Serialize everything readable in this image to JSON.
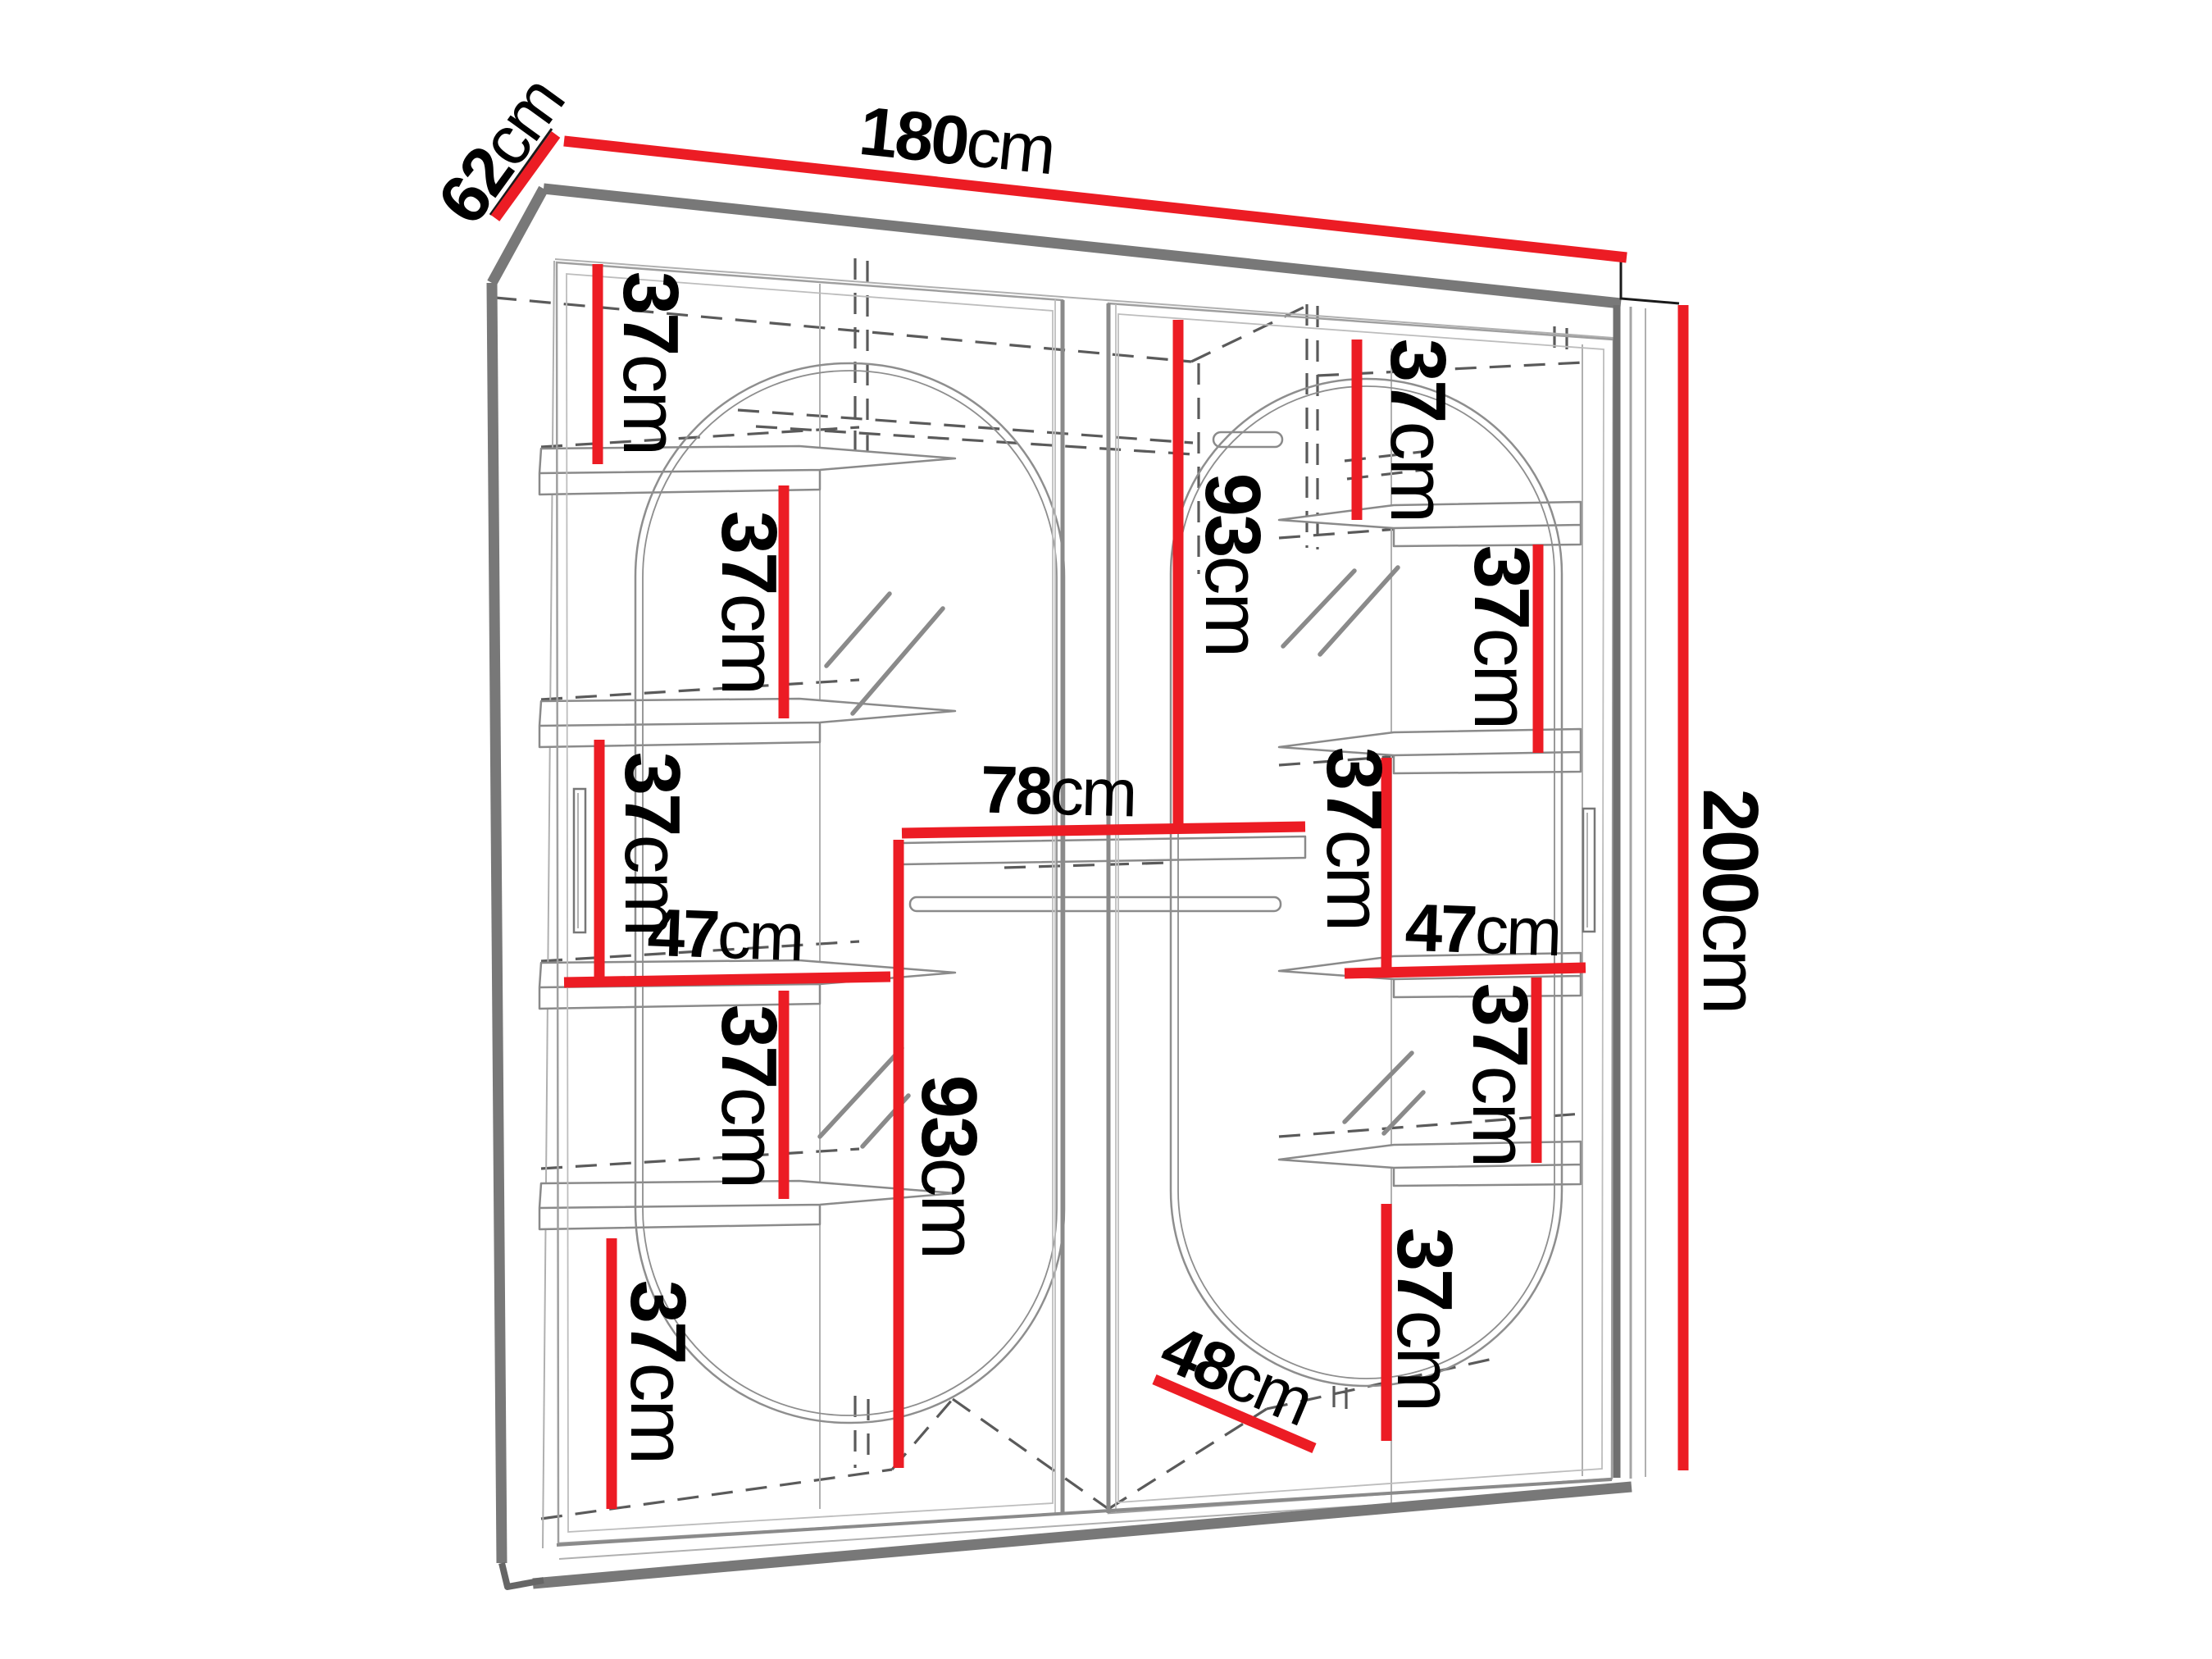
{
  "diagram": {
    "type": "furniture-dimension-diagram",
    "subject": "two-door sliding wardrobe with oval mirrors, interior shelves and hanging rails",
    "unit": "cm",
    "colors": {
      "dimension_line": "#ec1c24",
      "cabinet_outline_dark": "#787878",
      "cabinet_outline_light": "#9f9f9f",
      "dashed_hidden_line": "#5a5a5a",
      "text": "#000000",
      "background": "#ffffff"
    },
    "overall_dimensions": {
      "width_cm": 180,
      "depth_cm": 62,
      "height_cm": 200
    },
    "labels": {
      "width": {
        "num": "180",
        "unit": "cm"
      },
      "depth": {
        "num": "62",
        "unit": "cm"
      },
      "height": {
        "num": "200",
        "unit": "cm"
      },
      "left_gap_1": {
        "num": "37",
        "unit": "cm"
      },
      "left_gap_2": {
        "num": "37",
        "unit": "cm"
      },
      "left_gap_3": {
        "num": "37",
        "unit": "cm"
      },
      "left_shelf_width": {
        "num": "47",
        "unit": "cm"
      },
      "left_gap_4": {
        "num": "37",
        "unit": "cm"
      },
      "left_gap_5": {
        "num": "37",
        "unit": "cm"
      },
      "middle_width": {
        "num": "78",
        "unit": "cm"
      },
      "left_hanging_height": {
        "num": "93",
        "unit": "cm"
      },
      "right_hanging_height": {
        "num": "93",
        "unit": "cm"
      },
      "right_gap_1": {
        "num": "37",
        "unit": "cm"
      },
      "right_gap_2": {
        "num": "37",
        "unit": "cm"
      },
      "right_gap_3": {
        "num": "37",
        "unit": "cm"
      },
      "right_shelf_width": {
        "num": "47",
        "unit": "cm"
      },
      "right_gap_4": {
        "num": "37",
        "unit": "cm"
      },
      "right_gap_5": {
        "num": "37",
        "unit": "cm"
      },
      "interior_depth": {
        "num": "48",
        "unit": "cm"
      }
    }
  }
}
